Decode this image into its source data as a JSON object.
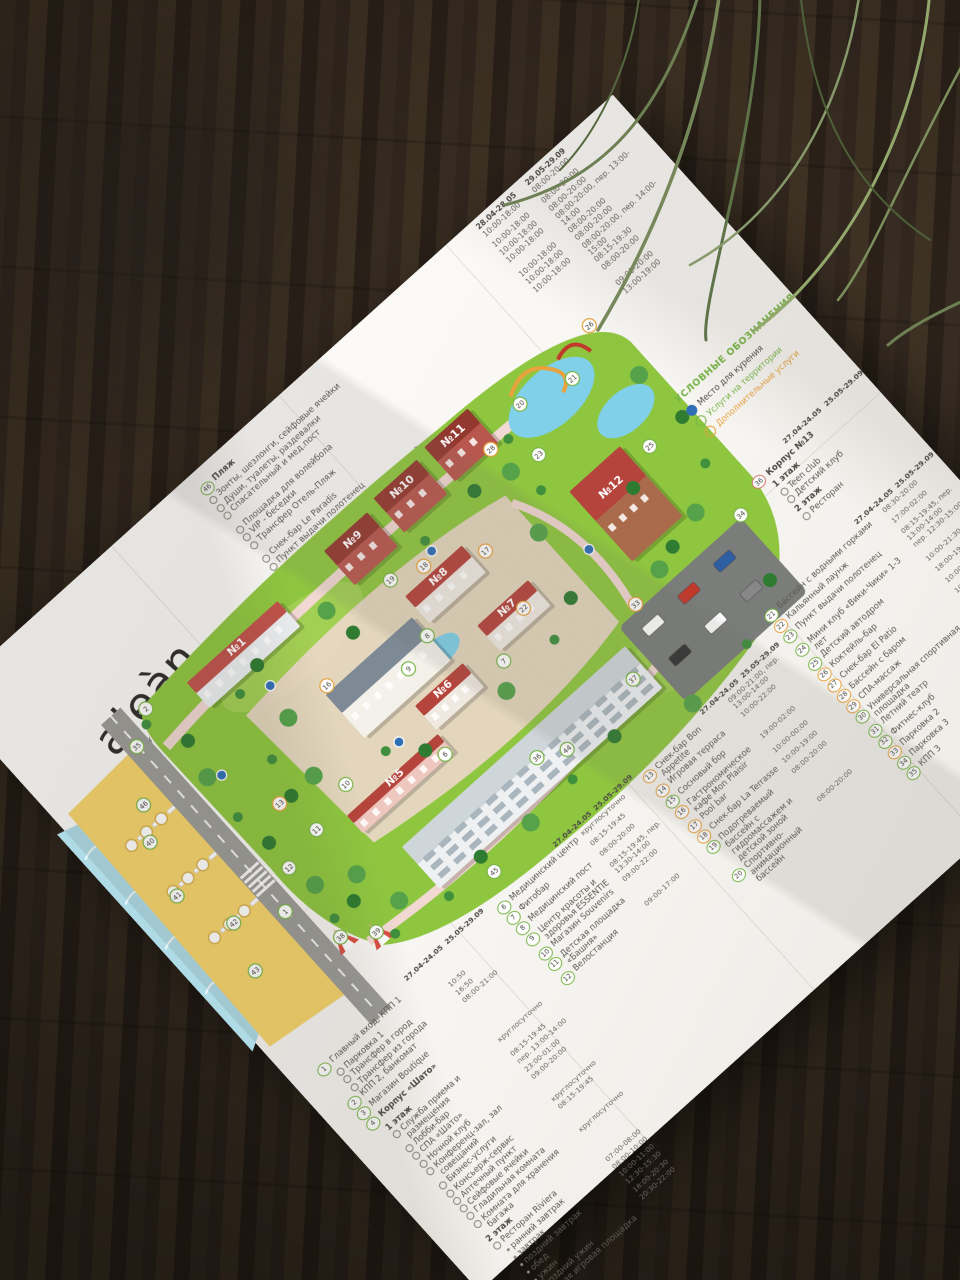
{
  "logo": {
    "brand": "aleàn",
    "tagline": "FAMILY RESORT & SPA",
    "name": "RIVIERA",
    "stars": "★ ★ ★ ★"
  },
  "beach_legend": {
    "season_headers": [
      "28.04-28.05",
      "29.05-29.09"
    ],
    "title_num": "46",
    "items": [
      {
        "num": "46",
        "label": "Пляж",
        "t1": "10:00-18:00",
        "t2": "08:00-20:00",
        "bold": true
      },
      {
        "label": "Зонты, шезлонги, сейфовые ячейки",
        "t1": "10:00-18:00",
        "t2": "08:00-20:00"
      },
      {
        "label": "Души, туалеты, раздевалки",
        "t1": "10:00-18:00",
        "t2": "08:00-20:00"
      },
      {
        "label": "Спасательный и мед.пост",
        "t1": "10:00-18:00",
        "t2": "08:00-20:00, пер. 13:00-14:00"
      },
      {
        "label": "Площадка для волейбола",
        "t1": "10:00-18:00",
        "t2": "08:00-20:00"
      },
      {
        "label": "VIP - беседки",
        "t1": "10:00-18:00",
        "t2": "08:00-20:00"
      },
      {
        "label": "Трансфер Отель-Пляж",
        "t1": "10:00-18:00",
        "t2": "08:00-20:00, пер. 14:00-15:00"
      },
      {
        "label": "Снек-бар Le Paradis",
        "t1": "",
        "t2": "08:15-19:30"
      },
      {
        "label": "Пункт выдачи полотенец",
        "t1": "",
        "t2": "08:00-20:00"
      },
      {
        "label": "Сцена для анимационных мероприятий",
        "t1": "",
        "t2": ""
      },
      {
        "label": "Детская игровая площадка",
        "t1": "",
        "t2": "09:00-20:00"
      },
      {
        "label": "Детский клуб",
        "t1": "",
        "t2": "13:00-19:00"
      },
      {
        "label": "Лазертаг",
        "t1": "",
        "t2": ""
      },
      {
        "label": "Лучный тир",
        "t1": "",
        "t2": ""
      },
      {
        "label": "Фитнес-площадка",
        "t1": "",
        "t2": ""
      }
    ]
  },
  "symbols_legend": {
    "title": "УСЛОВНЫЕ ОБОЗНАЧЕНИЯ",
    "items": [
      {
        "label": "Место для курения",
        "type": "smoking",
        "color": "#2e6fb6",
        "fill": true
      },
      {
        "label": "Услуги на территории",
        "type": "territory",
        "color": "#7ab648",
        "fill": false
      },
      {
        "label": "Дополнительные услуги",
        "type": "additional",
        "color": "#e8a23d",
        "fill": false
      }
    ]
  },
  "korpus13": {
    "season_headers": [
      "27.04-24.05",
      "25.05-29.09"
    ],
    "num": "36",
    "title": "Корпус №13",
    "floors": [
      {
        "name": "1 этаж",
        "items": [
          "Teen club",
          "Детский клуб"
        ]
      },
      {
        "name": "2 этаж",
        "items": [
          "Ресторан"
        ]
      }
    ]
  },
  "legend": {
    "orange_nums": [
      "13",
      "14",
      "16",
      "17",
      "18",
      "22",
      "26",
      "27",
      "28",
      "29",
      "33"
    ],
    "columns": [
      {
        "header": [
          "27.04-24.05",
          "25.05-29.09"
        ],
        "entries": [
          {
            "num": "1",
            "label": "Главный вход, КПП 1",
            "style": "item"
          },
          {
            "label": "Парковка 1",
            "style": "sub"
          },
          {
            "label": "Трансфер в город",
            "style": "sub",
            "tm": "10:50"
          },
          {
            "label": "Трансфер из города",
            "style": "sub",
            "tm": "16:50"
          },
          {
            "num": "2",
            "label": "КПП 2, банкомат",
            "style": "item",
            "tm": "08:00-21:00"
          },
          {
            "num": "3",
            "label": "Магазин Boutique",
            "style": "item"
          },
          {
            "num": "4",
            "label": "Корпус «Шато»",
            "style": "item bold"
          },
          {
            "label": "1 этаж",
            "style": "floor"
          },
          {
            "label": "Служба приема и размещения",
            "style": "sub",
            "tm": "круглосуточно"
          },
          {
            "label": "Лобби-бар",
            "style": "sub",
            "tm": "08:15-19:45"
          },
          {
            "label": "СПА «Шато»",
            "style": "sub",
            "tm": "пер. 13:00-14:00"
          },
          {
            "label": "Ночной клуб",
            "style": "sub",
            "tm": "23:00-01:00"
          },
          {
            "label": "Конференц-зал, зал совещаний",
            "style": "sub",
            "tm": "09:00-20:00"
          },
          {
            "label": "Бизнес-услуги",
            "style": "sub"
          },
          {
            "label": "Консьерж-сервис",
            "style": "sub",
            "tm": "круглосуточно"
          },
          {
            "label": "Аптечный пункт",
            "style": "sub",
            "tm": "08:15-19:45"
          },
          {
            "label": "Сейфовые ячейки",
            "style": "sub"
          },
          {
            "label": "Гладильная комната",
            "style": "sub"
          },
          {
            "label": "Комната для хранения багажа",
            "style": "sub",
            "tm": "круглосуточно"
          },
          {
            "label": "2 этаж",
            "style": "floor"
          },
          {
            "label": "Ресторан Riviera",
            "style": "sub"
          },
          {
            "label": "ранний завтрак",
            "style": "bullet",
            "tm": "07:00-08:00"
          },
          {
            "label": "завтрак",
            "style": "bullet",
            "tm": "08:00-10:00"
          },
          {
            "label": "поздний завтрак",
            "style": "bullet",
            "tm": "10:00-11:00"
          },
          {
            "label": "обед",
            "style": "bullet",
            "tm": "12:30-15:30"
          },
          {
            "label": "ужин",
            "style": "bullet",
            "tm": "18:00-20:30"
          },
          {
            "label": "поздний ужин",
            "style": "bullet",
            "tm": "20:30-22:00"
          },
          {
            "num": "5",
            "label": "Детская игровая площадка",
            "style": "item"
          }
        ]
      },
      {
        "header": [
          "27.04-24.05",
          "25.05-29.09"
        ],
        "entries": [
          {
            "num": "6",
            "label": "Медицинский центр",
            "style": "item",
            "tm": "круглосуточно"
          },
          {
            "num": "7",
            "label": "Фитобар",
            "style": "item",
            "tm": "08:15-19:45"
          },
          {
            "num": "8",
            "label": "Медицинский пост",
            "style": "item",
            "tm": "08:00-20:00"
          },
          {
            "num": "9",
            "label": "Центр красоты и здоровья ESSENTIE",
            "style": "item",
            "tm": "08:15-19:45, пер. 13:30-14:00"
          },
          {
            "num": "10",
            "label": "Магазин Souvenirs",
            "style": "item",
            "tm": "09:00-22:00"
          },
          {
            "num": "11",
            "label": "Детская площадка «Башня»",
            "style": "item"
          },
          {
            "num": "12",
            "label": "Велостанция",
            "style": "item",
            "tm": "09:00-17:00"
          }
        ]
      },
      {
        "header": [
          "27.04-24.05",
          "25.05-29.09"
        ],
        "entries": [
          {
            "num": "13",
            "label": "Снек-бар Bon Appetite",
            "style": "item",
            "tm": "09:00-21:00, пер. 13:00-14:00"
          },
          {
            "num": "14",
            "label": "Игровая терраса",
            "style": "item",
            "tm": "10:00-22:00"
          },
          {
            "num": "15",
            "label": "Сосновый бор",
            "style": "item"
          },
          {
            "num": "16",
            "label": "Гастрономическое кафе Mon Plaisir",
            "style": "item",
            "tm": "19:00-02:00"
          },
          {
            "num": "17",
            "label": "Pool bar",
            "style": "item",
            "tm": "10:00-00:00"
          },
          {
            "num": "18",
            "label": "Снек-бар La Terrasse",
            "style": "item",
            "tm": "10:00-19:00"
          },
          {
            "num": "19",
            "label": "Подогреваемый бассейн с гидромассажем и детской зоной",
            "style": "item",
            "tm": "08:00-20:00"
          },
          {
            "num": "20",
            "label": "Спортивно-анимационный бассейн",
            "style": "item",
            "tm": "08:00-20:00"
          }
        ]
      },
      {
        "header": [
          "27.04-24.05",
          "25.05-29.09"
        ],
        "entries": [
          {
            "num": "21",
            "label": "Бассейн с водными горками",
            "style": "item",
            "tm": "08:30-20:00"
          },
          {
            "num": "22",
            "label": "Кальянный лаунж",
            "style": "item",
            "tm": "17:00-02:00"
          },
          {
            "num": "23",
            "label": "Пункт выдачи полотенец",
            "style": "item",
            "tm": "08:15-19:45, пер. 13:00-14:00"
          },
          {
            "num": "24",
            "label": "Мини клуб «Вики-Чики» 1-3 лет",
            "style": "item",
            "tm": "пер. 12:30-15:00"
          },
          {
            "num": "25",
            "label": "Детский автодром",
            "style": "item",
            "tm": "10:00-21:30"
          },
          {
            "num": "26",
            "label": "Коктейль-бар",
            "style": "item",
            "tm": "18:00-19:00"
          },
          {
            "num": "27",
            "label": "Снек-бар El Patio",
            "style": "item",
            "tm": "10:00-21:00"
          },
          {
            "num": "28",
            "label": "Бассейн с баром",
            "style": "item",
            "tm": "10:00-21:00"
          },
          {
            "num": "29",
            "label": "СПА-массаж",
            "style": "item",
            "tm": "08:00-20:00"
          },
          {
            "num": "30",
            "label": "Универсальная спортивная площадка",
            "style": "item",
            "tm": "08:00-20:00"
          },
          {
            "num": "31",
            "label": "Летний театр",
            "style": "item"
          },
          {
            "num": "32",
            "label": "Фитнес-клуб",
            "style": "item"
          },
          {
            "num": "33",
            "label": "Парковка 2",
            "style": "item"
          },
          {
            "num": "34",
            "label": "Парковка 3",
            "style": "item"
          },
          {
            "num": "35",
            "label": "КПП 3",
            "style": "item"
          }
        ]
      }
    ]
  },
  "map": {
    "colors": {
      "grass": "#8fc63f",
      "grass_light": "#a9d45c",
      "tree": "#3f8f3c",
      "tree_dark": "#2e7b31",
      "path": "#f2d8d2",
      "road": "#9b9b97",
      "sand": "#f6d46a",
      "sea": "#aedbe6",
      "pool": "#7fd0e8",
      "roof_red": "#b5443c",
      "parking": "#7a7d7a",
      "smoking": "#2e6fb6"
    },
    "buildings": [
      {
        "label": "№1",
        "x": 198,
        "y": 26,
        "w": 122,
        "h": 34,
        "wall": "#eceff1",
        "roof": "#c0524a"
      },
      {
        "label": "№9",
        "x": 388,
        "y": 20,
        "w": 58,
        "h": 46,
        "wall": "#b8574d",
        "roof": "#93382f"
      },
      {
        "label": "№10",
        "x": 460,
        "y": 14,
        "w": 58,
        "h": 46,
        "wall": "#b8574d",
        "roof": "#93382f"
      },
      {
        "label": "№11",
        "x": 532,
        "y": 10,
        "w": 58,
        "h": 46,
        "wall": "#b8574d",
        "roof": "#93382f"
      },
      {
        "label": "№8",
        "x": 418,
        "y": 108,
        "w": 76,
        "h": 36,
        "wall": "#f0e9e2",
        "roof": "#b5443c"
      },
      {
        "label": "№7",
        "x": 452,
        "y": 178,
        "w": 68,
        "h": 34,
        "wall": "#f0e9e2",
        "roof": "#b5443c"
      },
      {
        "label": "№6",
        "x": 352,
        "y": 196,
        "w": 64,
        "h": 32,
        "wall": "#f0e9e2",
        "roof": "#b5443c"
      },
      {
        "label": "№5",
        "x": 228,
        "y": 232,
        "w": 122,
        "h": 24,
        "wall": "#eec7bf",
        "roof": "#b5443c"
      },
      {
        "label": "",
        "x": 293,
        "y": 128,
        "w": 116,
        "h": 58,
        "wall": "#f3f1ea",
        "roof": "#7d8a96"
      },
      {
        "label": "№12",
        "x": 610,
        "y": 140,
        "w": 68,
        "h": 94,
        "wall": "#aa6b4d",
        "roof": "#b5443c"
      },
      {
        "label": "",
        "x": 248,
        "y": 292,
        "w": 300,
        "h": 56,
        "wall": "#eef0f2",
        "roof": "#cfd6da",
        "type": "hotel"
      }
    ],
    "markers": [
      {
        "n": "1",
        "x": 118,
        "y": 262
      },
      {
        "n": "2",
        "x": 150,
        "y": 18
      },
      {
        "n": "6",
        "x": 342,
        "y": 252
      },
      {
        "n": "7",
        "x": 448,
        "y": 222
      },
      {
        "n": "8",
        "x": 408,
        "y": 152
      },
      {
        "n": "9",
        "x": 372,
        "y": 164
      },
      {
        "n": "10",
        "x": 248,
        "y": 208
      },
      {
        "n": "11",
        "x": 196,
        "y": 222
      },
      {
        "n": "12",
        "x": 150,
        "y": 232
      },
      {
        "n": "13",
        "x": 186,
        "y": 178
      },
      {
        "n": "16",
        "x": 300,
        "y": 122
      },
      {
        "n": "17",
        "x": 508,
        "y": 128
      },
      {
        "n": "18",
        "x": 452,
        "y": 98
      },
      {
        "n": "19",
        "x": 418,
        "y": 86
      },
      {
        "n": "20",
        "x": 632,
        "y": 42
      },
      {
        "n": "21",
        "x": 688,
        "y": 58
      },
      {
        "n": "22",
        "x": 498,
        "y": 196
      },
      {
        "n": "23",
        "x": 612,
        "y": 92
      },
      {
        "n": "25",
        "x": 700,
        "y": 160
      },
      {
        "n": "26",
        "x": 736,
        "y": 30
      },
      {
        "n": "28",
        "x": 580,
        "y": 56
      },
      {
        "n": "33",
        "x": 584,
        "y": 268
      },
      {
        "n": "34",
        "x": 722,
        "y": 272
      },
      {
        "n": "35",
        "x": 118,
        "y": 40
      },
      {
        "n": "36",
        "x": 408,
        "y": 316
      },
      {
        "n": "37",
        "x": 532,
        "y": 322
      },
      {
        "n": "38",
        "x": 142,
        "y": 318
      },
      {
        "n": "39",
        "x": 172,
        "y": 338
      },
      {
        "n": "40",
        "x": 64,
        "y": 120
      },
      {
        "n": "41",
        "x": 48,
        "y": 178
      },
      {
        "n": "42",
        "x": 72,
        "y": 236
      },
      {
        "n": "43",
        "x": 56,
        "y": 286
      },
      {
        "n": "44",
        "x": 436,
        "y": 330
      },
      {
        "n": "45",
        "x": 300,
        "y": 372
      },
      {
        "n": "46",
        "x": 84,
        "y": 88
      }
    ],
    "smoking_spots": [
      {
        "x": 258,
        "y": 84
      },
      {
        "x": 162,
        "y": 118
      },
      {
        "x": 316,
        "y": 212
      },
      {
        "x": 468,
        "y": 92
      },
      {
        "x": 586,
        "y": 196
      }
    ]
  }
}
